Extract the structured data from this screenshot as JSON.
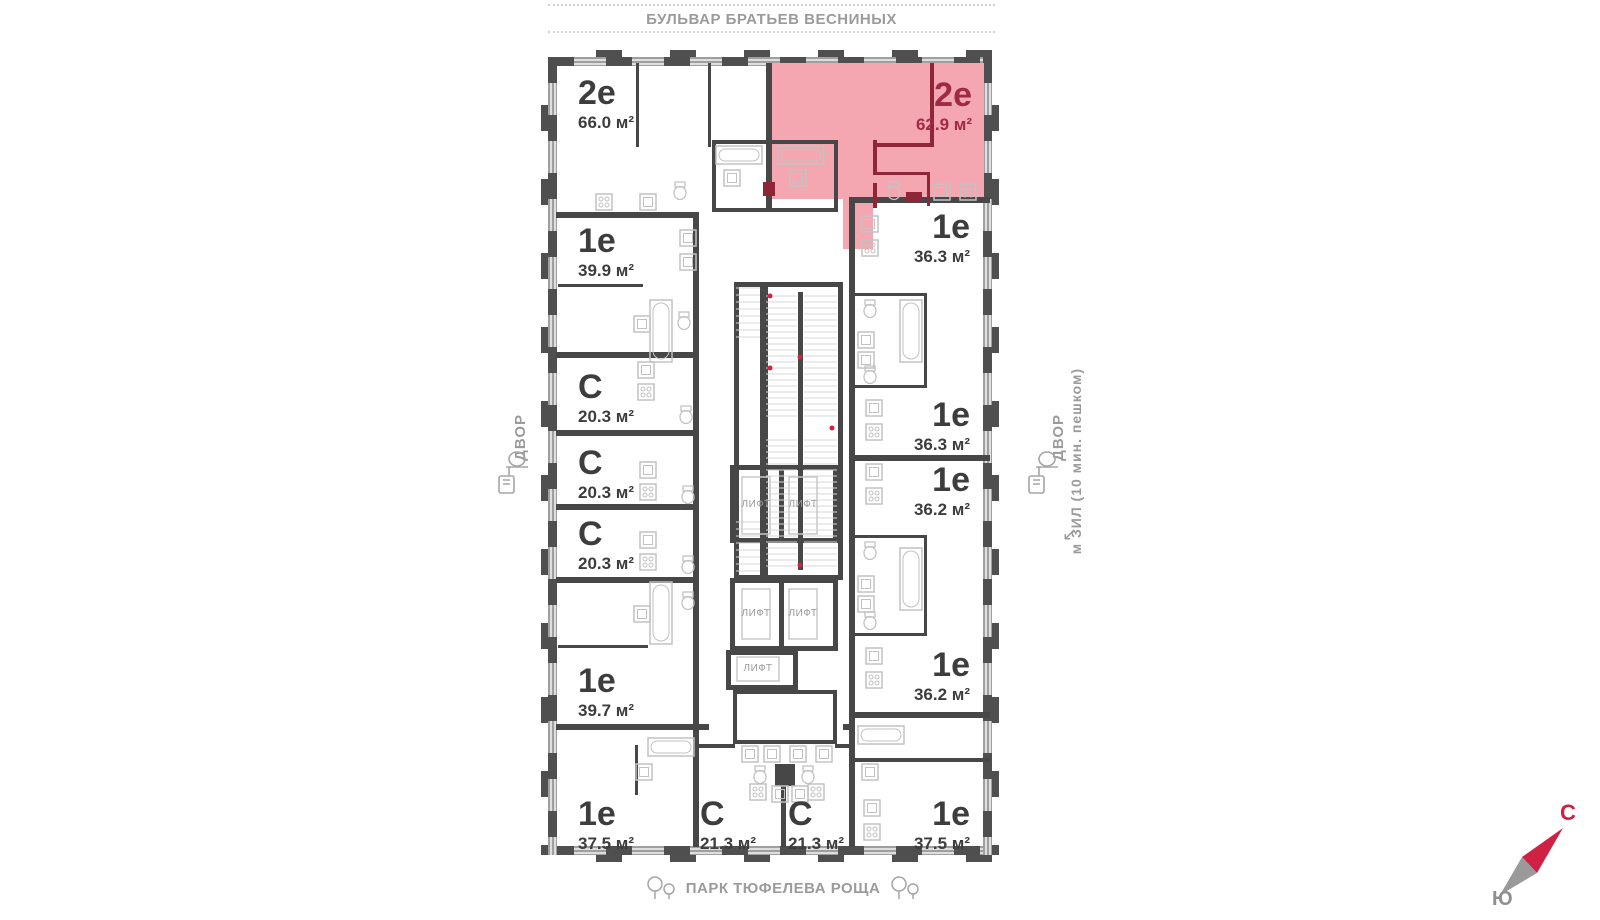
{
  "streets": {
    "top": "БУЛЬВАР БРАТЬЕВ ВЕСНИНЫХ",
    "bottom": "ПАРК ТЮФЕЛЕВА РОЩА"
  },
  "labels": {
    "courtyard_left": "ДВОР",
    "courtyard_right": "ДВОР",
    "metro": "м ЗИЛ (10 мин. пешком)",
    "metro_arrow": "↙"
  },
  "compass": {
    "north": "С",
    "south": "Ю"
  },
  "lifts": [
    "ЛИФТ",
    "ЛИФТ",
    "ЛИФТ",
    "ЛИФТ",
    "ЛИФТ"
  ],
  "units": [
    {
      "type": "2е",
      "area": "66.0 м²",
      "highlighted": false
    },
    {
      "type": "2е",
      "area": "62.9 м²",
      "highlighted": true
    },
    {
      "type": "1е",
      "area": "39.9 м²",
      "highlighted": false
    },
    {
      "type": "1е",
      "area": "36.3 м²",
      "highlighted": false
    },
    {
      "type": "С",
      "area": "20.3 м²",
      "highlighted": false
    },
    {
      "type": "С",
      "area": "20.3 м²",
      "highlighted": false
    },
    {
      "type": "С",
      "area": "20.3 м²",
      "highlighted": false
    },
    {
      "type": "1е",
      "area": "36.3 м²",
      "highlighted": false
    },
    {
      "type": "1е",
      "area": "36.2 м²",
      "highlighted": false
    },
    {
      "type": "1е",
      "area": "39.7 м²",
      "highlighted": false
    },
    {
      "type": "1е",
      "area": "36.2 м²",
      "highlighted": false
    },
    {
      "type": "1е",
      "area": "37.5 м²",
      "highlighted": false
    },
    {
      "type": "С",
      "area": "21.3 м²",
      "highlighted": false
    },
    {
      "type": "С",
      "area": "21.3 м²",
      "highlighted": false
    },
    {
      "type": "1е",
      "area": "37.5 м²",
      "highlighted": false
    }
  ],
  "colors": {
    "highlight_fill": "#f4a7b0",
    "highlight_wall": "#8e2638",
    "highlight_text": "#a02a46",
    "wall": "#474747",
    "accent_red": "#ce2144"
  }
}
